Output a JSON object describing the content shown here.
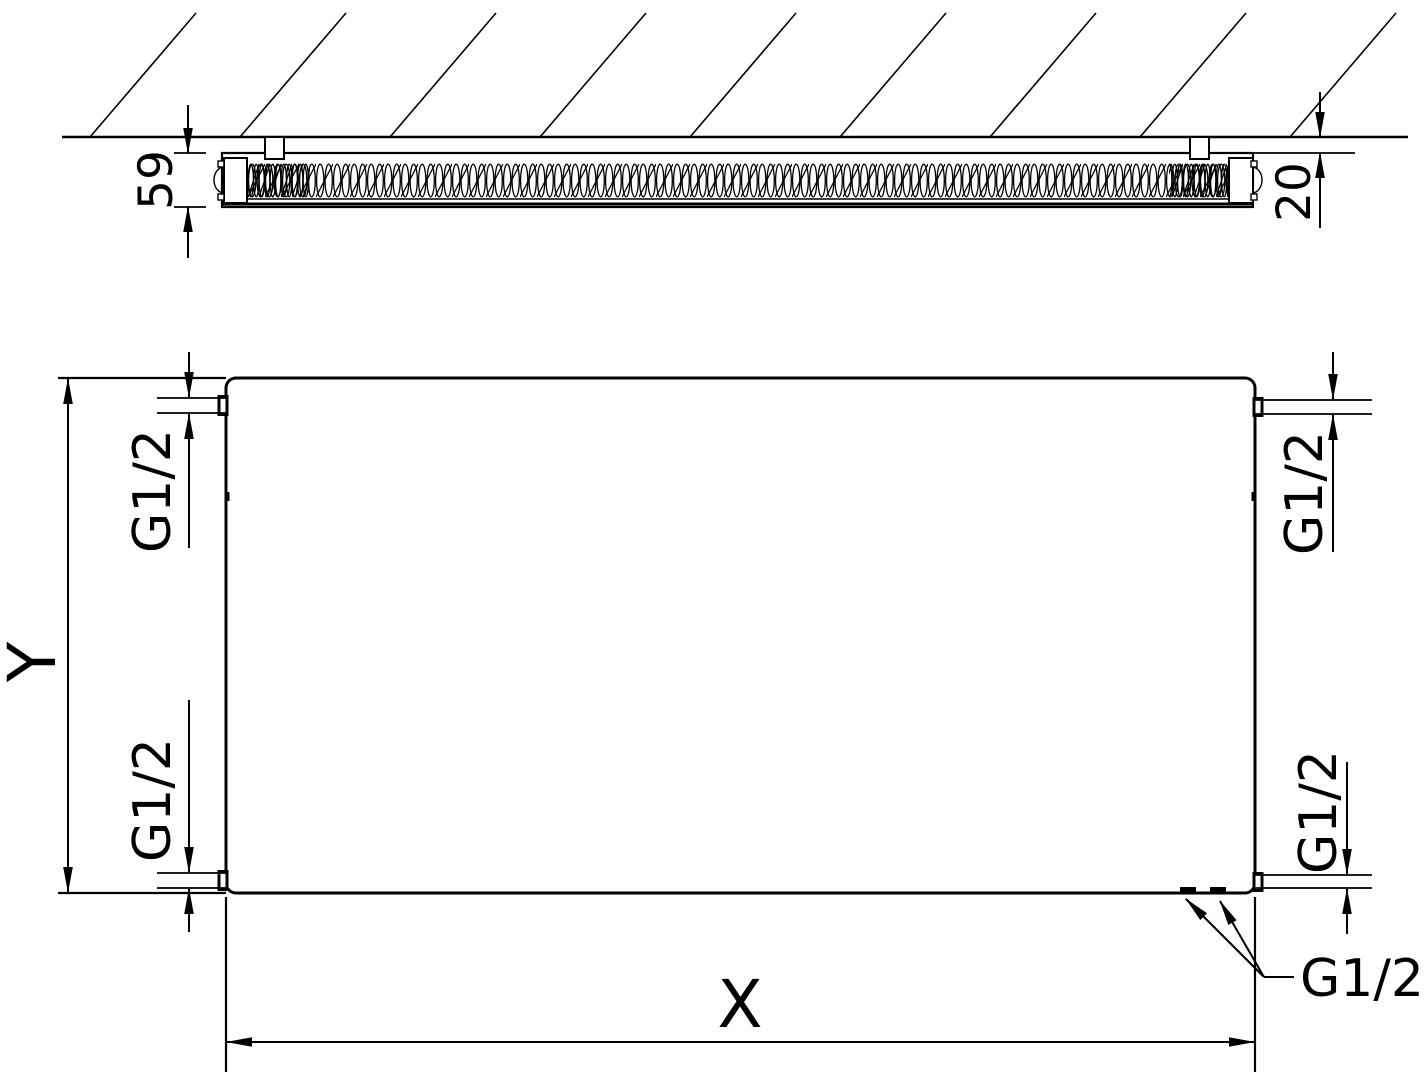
{
  "drawing": {
    "top_view": {
      "depth_dim": "59",
      "wall_gap_dim": "20"
    },
    "front_view": {
      "height_dim": "Y",
      "width_dim": "X",
      "conn_top_left": "G1/2",
      "conn_bottom_left": "G1/2",
      "conn_top_right": "G1/2",
      "conn_bottom_right": "G1/2",
      "conn_bottom_center": "G1/2"
    },
    "colors": {
      "line": "#000000",
      "background": "#ffffff"
    }
  }
}
